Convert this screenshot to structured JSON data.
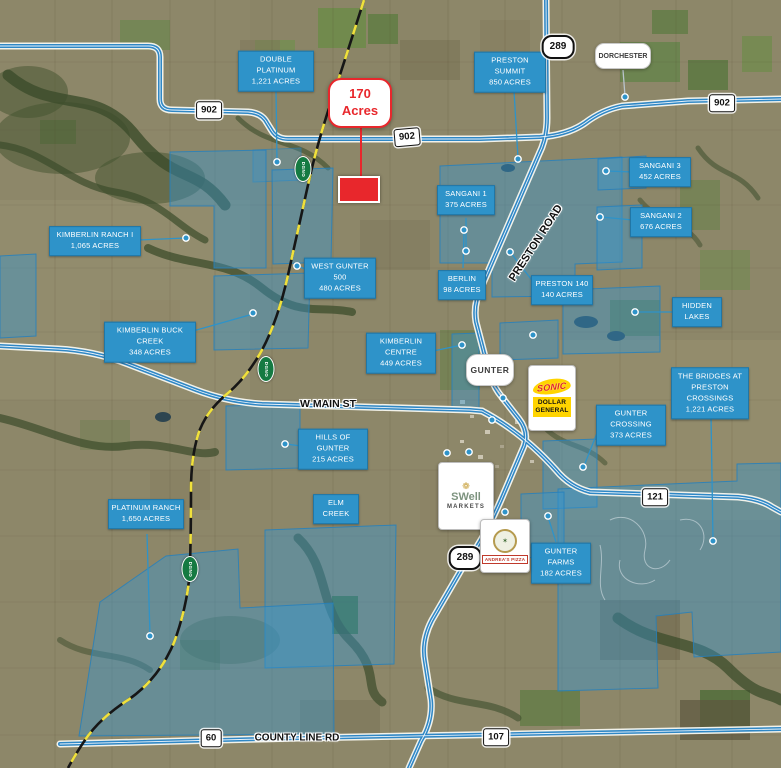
{
  "subject_callout": {
    "line1": "170",
    "line2": "Acres"
  },
  "town_callouts": {
    "gunter": "GUNTER",
    "dorchester": "DORCHESTER"
  },
  "highway_shields": {
    "h902": "902",
    "h289": "289",
    "h121": "121",
    "h60": "60",
    "h107": "107"
  },
  "road_labels": {
    "preston_road": "PRESTON ROAD",
    "w_main_st": "W MAIN ST",
    "county_line_rd": "COUNTY LINE RD"
  },
  "railroad": {
    "operator": "DGNO"
  },
  "logos": {
    "sonic": "SONIC",
    "dollar_general_line1": "DOLLAR",
    "dollar_general_line2": "GENERAL",
    "swell_line1": "SWell",
    "swell_line2": "MARKETS",
    "andreas_pizza": "ANDREA'S PIZZA",
    "andreas_badge_star": "✶"
  },
  "parcels": [
    {
      "name": "DOUBLE PLATINUM",
      "acres": "1,221 ACRES"
    },
    {
      "name": "PRESTON SUMMIT",
      "acres": "850 ACRES"
    },
    {
      "name": "SANGANI 3",
      "acres": "452 ACRES"
    },
    {
      "name": "SANGANI 2",
      "acres": "676 ACRES"
    },
    {
      "name": "SANGANI 1",
      "acres": "375 ACRES"
    },
    {
      "name": "KIMBERLIN RANCH I",
      "acres": "1,065 ACRES"
    },
    {
      "name": "WEST GUNTER 500",
      "acres": "480 ACRES"
    },
    {
      "name": "BERLIN",
      "acres": "98 ACRES"
    },
    {
      "name": "PRESTON 140",
      "acres": "140 ACRES"
    },
    {
      "name": "HIDDEN LAKES",
      "acres": ""
    },
    {
      "name": "KIMBERLIN BUCK CREEK",
      "acres": "348 ACRES"
    },
    {
      "name": "KIMBERLIN CENTRE",
      "acres": "449 ACRES"
    },
    {
      "name": "THE BRIDGES AT PRESTON CROSSINGS",
      "acres": "1,221 ACRES"
    },
    {
      "name": "GUNTER CROSSING",
      "acres": "373 ACRES"
    },
    {
      "name": "HILLS OF GUNTER",
      "acres": "215 ACRES"
    },
    {
      "name": "ELM CREEK",
      "acres": ""
    },
    {
      "name": "PLATINUM RANCH",
      "acres": "1,650 ACRES"
    },
    {
      "name": "GUNTER FARMS",
      "acres": "182 ACRES"
    }
  ],
  "colors": {
    "label_blue": "#2e93c9",
    "parcel_fill_blue": "#3a98cf",
    "subject_red": "#e8272c",
    "road_blue": "#2f87c5",
    "rail_yellow": "#f0e13c",
    "rail_oval_green": "#157a42",
    "dollar_general_yellow": "#ffd400"
  }
}
